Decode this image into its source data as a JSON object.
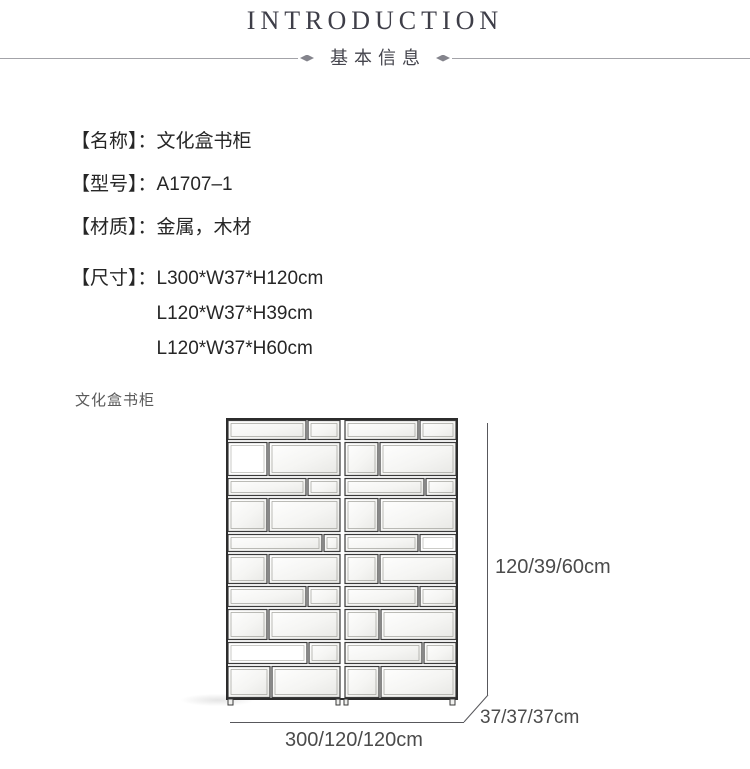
{
  "header": {
    "title": "INTRODUCTION",
    "subtitle": "基本信息"
  },
  "specs": [
    {
      "label": "【名称】：",
      "value": "文化盒书柜"
    },
    {
      "label": "【型号】：",
      "value": "A1707–1"
    },
    {
      "label": "【材质】：",
      "value": "金属，木材"
    },
    {
      "label": "【尺寸】：",
      "values": [
        "L300*W37*H120cm",
        "L120*W37*H39cm",
        "L120*W37*H60cm"
      ]
    }
  ],
  "figure": {
    "caption": "文化盒书柜",
    "dimensions": {
      "height": "120/39/60cm",
      "depth": "37/37/37cm",
      "width": "300/120/120cm"
    }
  },
  "palette": {
    "title_color": "#3e3e48",
    "text_color": "#262626",
    "muted_color": "#5a5a5a",
    "rule_color": "#a3a3a8"
  }
}
